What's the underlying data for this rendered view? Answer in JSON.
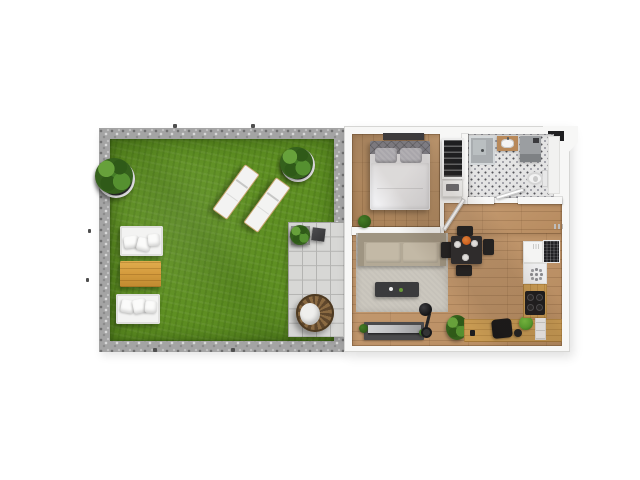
{
  "scene": {
    "type": "3d-floor-plan-top-view",
    "areas": [
      {
        "name": "garden-terrace",
        "surface": "lawn",
        "features": [
          "gravel-border",
          "white-edge-strip",
          "paved-patio"
        ]
      },
      {
        "name": "bedroom",
        "surface": "wood-plank"
      },
      {
        "name": "bathroom",
        "surface": "patterned-tile"
      },
      {
        "name": "living-room-kitchen",
        "surface": "wood-plank"
      }
    ],
    "garden_items": [
      "potted-plant",
      "potted-plant",
      "sun-lounger",
      "sun-lounger",
      "outdoor-sofa",
      "outdoor-coffee-table",
      "outdoor-sofa",
      "patio-shrub",
      "side-table-cube",
      "hanging-egg-chair"
    ],
    "bedroom_items": [
      "wall-shelf",
      "double-bed",
      "pillows",
      "wardrobe",
      "dresser",
      "plant"
    ],
    "bathroom_items": [
      "shower",
      "sink-vanity",
      "washing-machine",
      "toilet"
    ],
    "living_items": [
      "rug",
      "sofa",
      "coffee-table",
      "dining-table",
      "dining-chair",
      "dining-chair",
      "dining-chair",
      "dining-chair",
      "tv-stand",
      "tv",
      "floor-lamp",
      "plant",
      "desk",
      "office-chair",
      "stool"
    ],
    "kitchen_items": [
      "fridge",
      "bottle-rack",
      "sink-unit",
      "cooktop",
      "counter",
      "drawer-unit",
      "counter-plant"
    ]
  },
  "colors": {
    "bg": "#ffffff",
    "grass": "#5e8f22",
    "gravel": "#a4a4a4",
    "gravelDark": "#6f6f6f",
    "gravelLight": "#d9d9d9",
    "patioTile": "#d7d7d5",
    "patioLine": "#b4b4b2",
    "woodLiving": "#c09264",
    "woodBedroom": "#b2885c",
    "wall": "#f7f7f6",
    "wallEdge": "#d6d6d4",
    "bathTile": "#e4e4e4",
    "bathDot": "#55555a",
    "rug": "#cbc7be",
    "sofa": "#b3a996",
    "sofaDark": "#9f9582",
    "cushionC": "#c3b9a6",
    "duvet": "#ebebed",
    "pillowBed": "#b5b5bd",
    "headboard": "#81818a",
    "darkFurn": "#1d1d1f",
    "counterWood": "#c89a52",
    "outdoorWood": "#d59c3e",
    "whiteFurn": "#f3f3f2",
    "leafDark": "#2f5a18",
    "leaf": "#447c26",
    "leafLight": "#67a13b",
    "leafBright": "#58a42c",
    "wicker": "#8a6a42",
    "wickerDark": "#5f472c",
    "tvSilver": "#c3c4c6",
    "orange": "#e0661c",
    "appliance": "#9b9ea1",
    "showerTray": "#a9adb0",
    "glass": "#d3d7d9",
    "vanityWood": "#b8895a",
    "doorWhite": "#fdfdfd"
  }
}
